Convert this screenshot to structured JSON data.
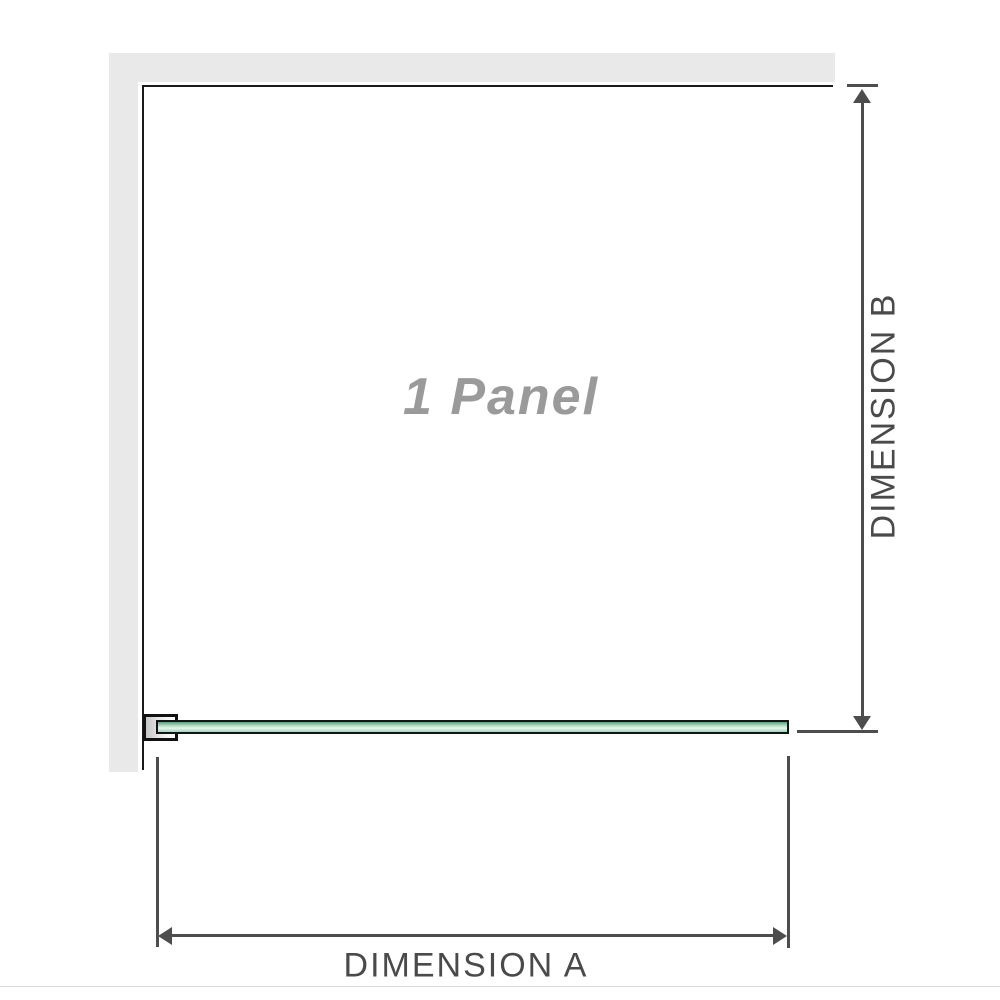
{
  "diagram": {
    "panel_label": "1 Panel",
    "dimension_a_label": "DIMENSION A",
    "dimension_b_label": "DIMENSION B"
  },
  "icons": {
    "arrow-up-icon": "css-triangle-up",
    "arrow-down-icon": "css-triangle-down",
    "arrow-left-icon": "css-triangle-left",
    "arrow-right-icon": "css-triangle-right"
  },
  "colors": {
    "wall_gray": "#e9e9e9",
    "outline_black": "#1a1a1a",
    "dimension_gray": "#4d4d4d",
    "panel_label_gray": "#9a9a9a",
    "glass_green_top": "#569f7c",
    "glass_green_mid": "#c9ebda",
    "glass_green_bottom": "#a8d4bf",
    "bracket_metal_gray": "#c6c6c6"
  }
}
